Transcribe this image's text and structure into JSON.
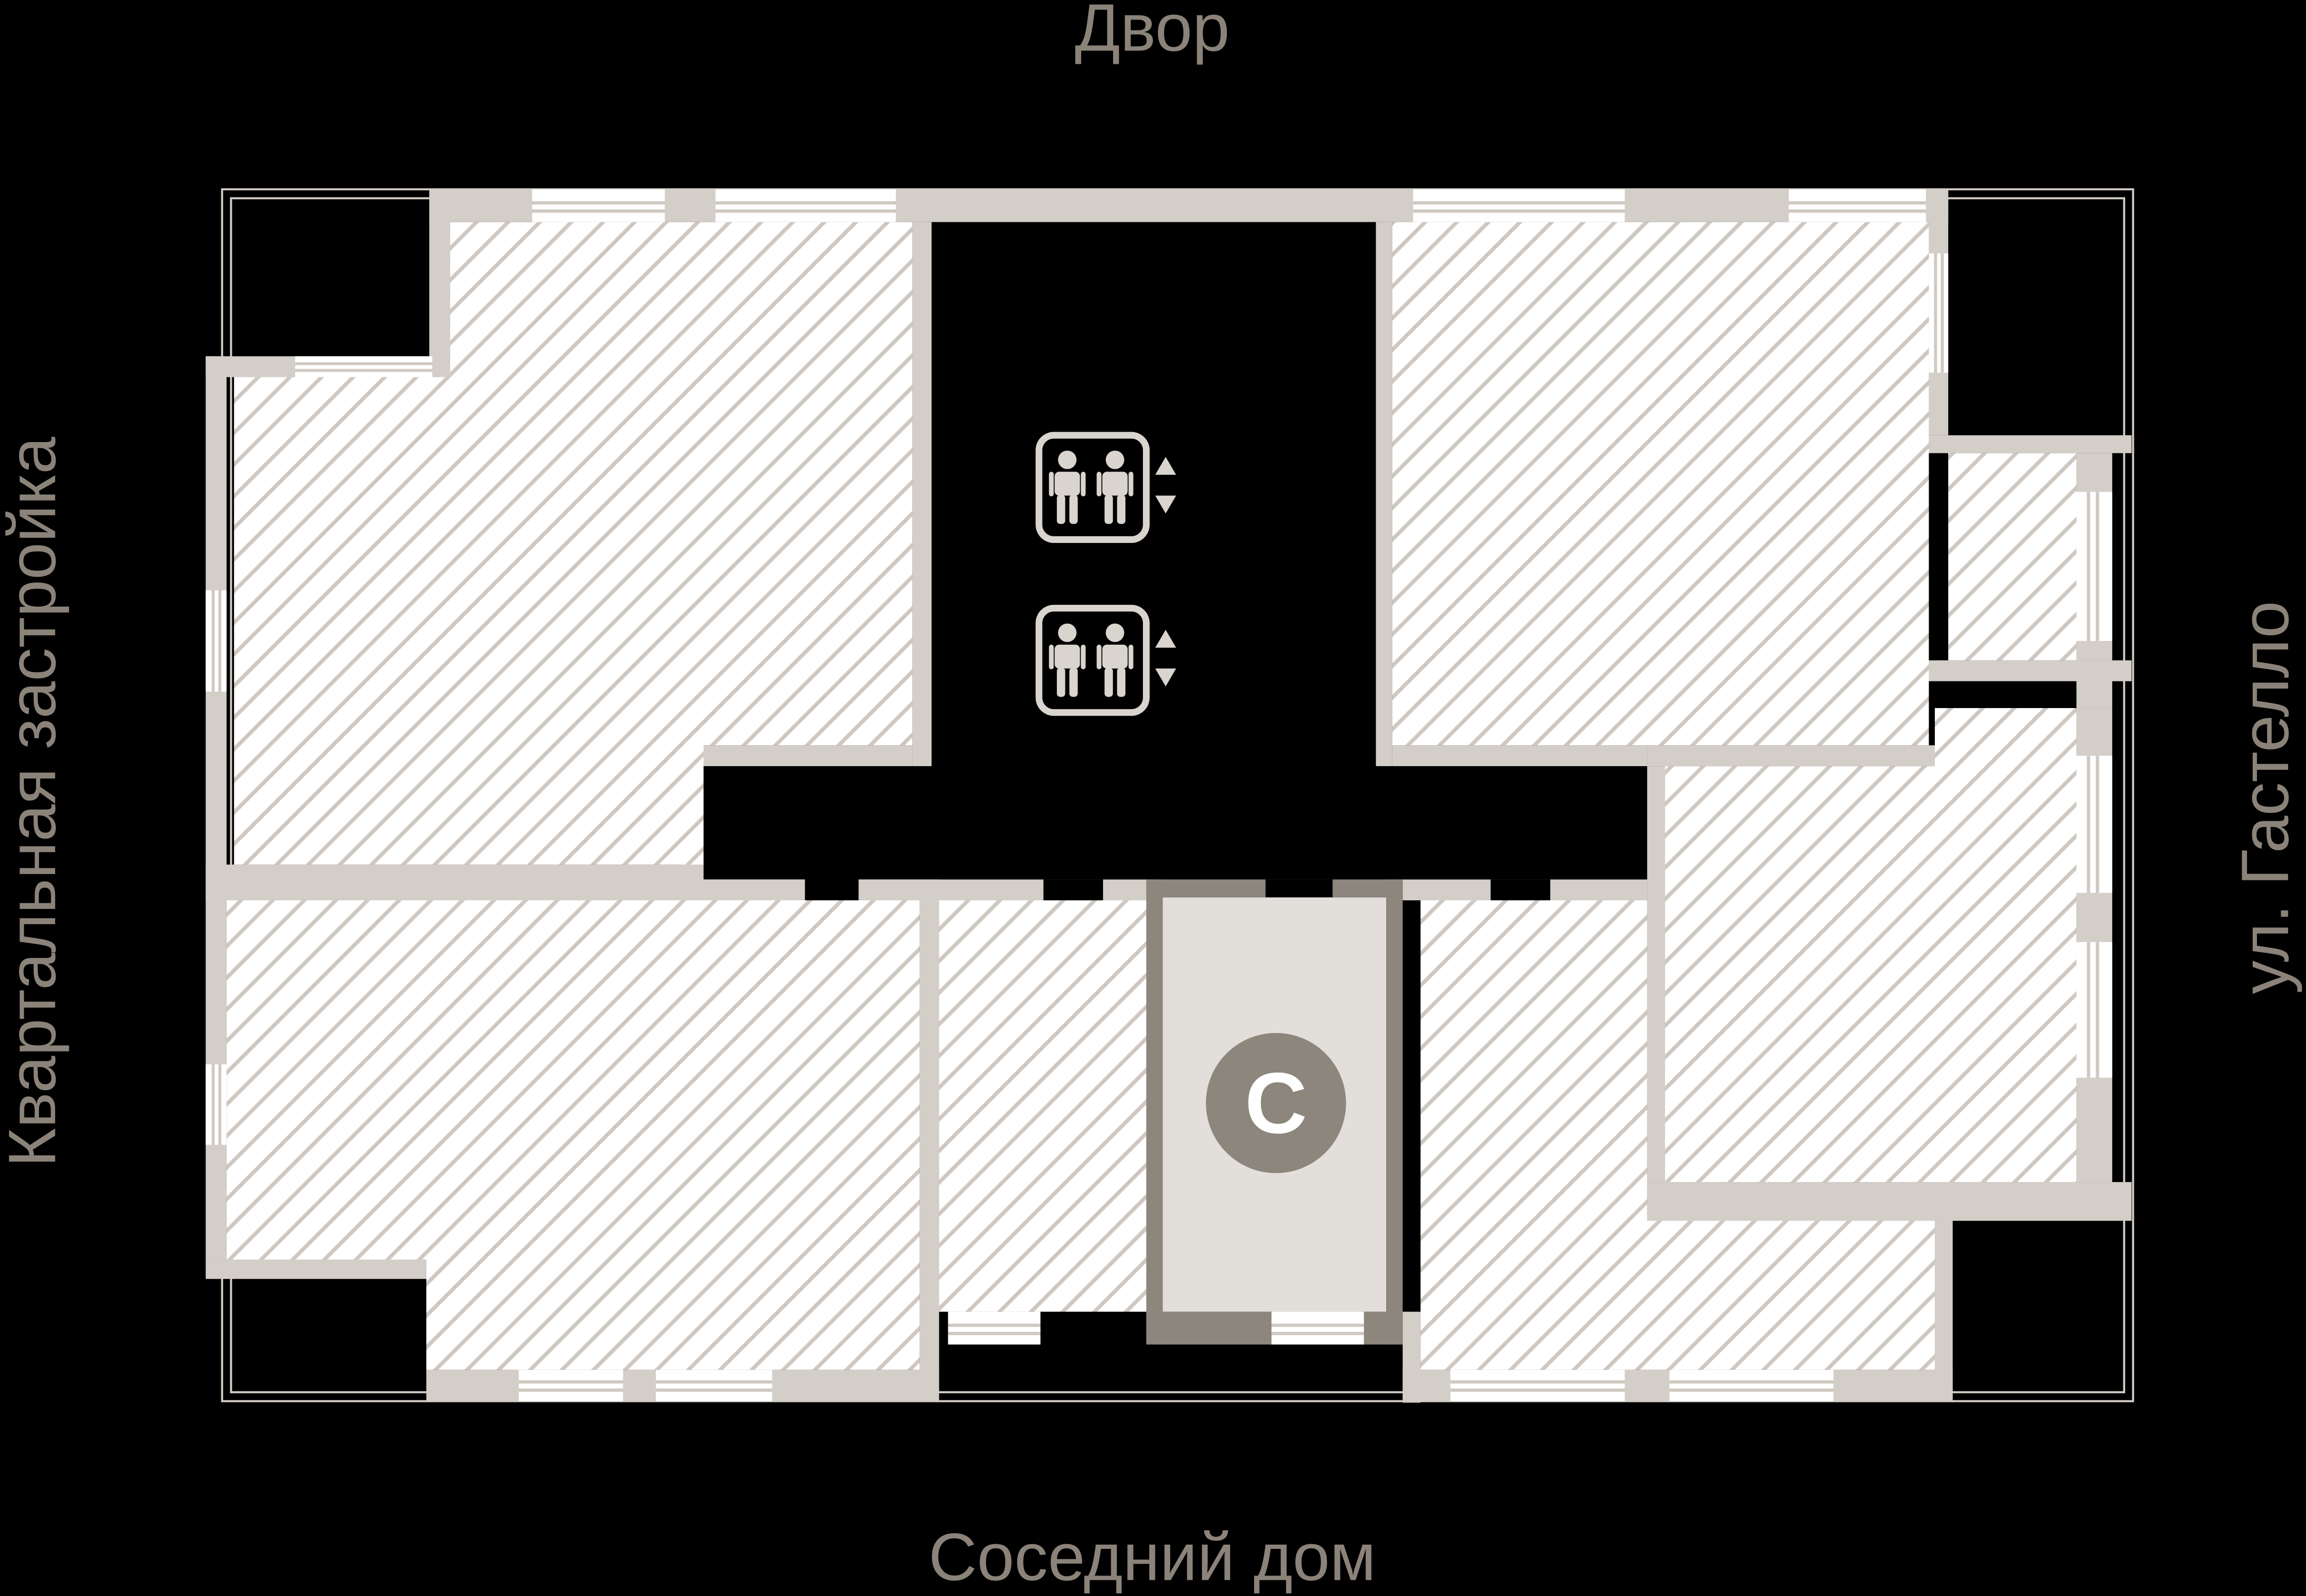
{
  "page": {
    "background_color": "#000000",
    "description_labels_color": "#8b8379"
  },
  "labels": {
    "top": "Двор",
    "bottom": "Соседний дом",
    "left": "Квартальная застройка",
    "right": "ул. Гастелло"
  },
  "north_indicator": {
    "letter": "С",
    "circle_color": "#8d867d",
    "letter_color": "#ffffff"
  },
  "floor_plan": {
    "wall_color": "#d3cec7",
    "dark_wall_color": "#8d867d",
    "hatch_line_color": "#cfc8c1",
    "room_fill": "#ffffff",
    "core_fill": "#000000",
    "vestibule_fill": "#e2dfda",
    "site_outline_color": "#cfc9c2",
    "elevator_icon_color": "#d9d4ce",
    "elevator_icons": [
      {
        "name": "elevator-icon",
        "passengers": 2,
        "arrows": "up-down"
      },
      {
        "name": "elevator-icon",
        "passengers": 2,
        "arrows": "up-down"
      }
    ]
  }
}
